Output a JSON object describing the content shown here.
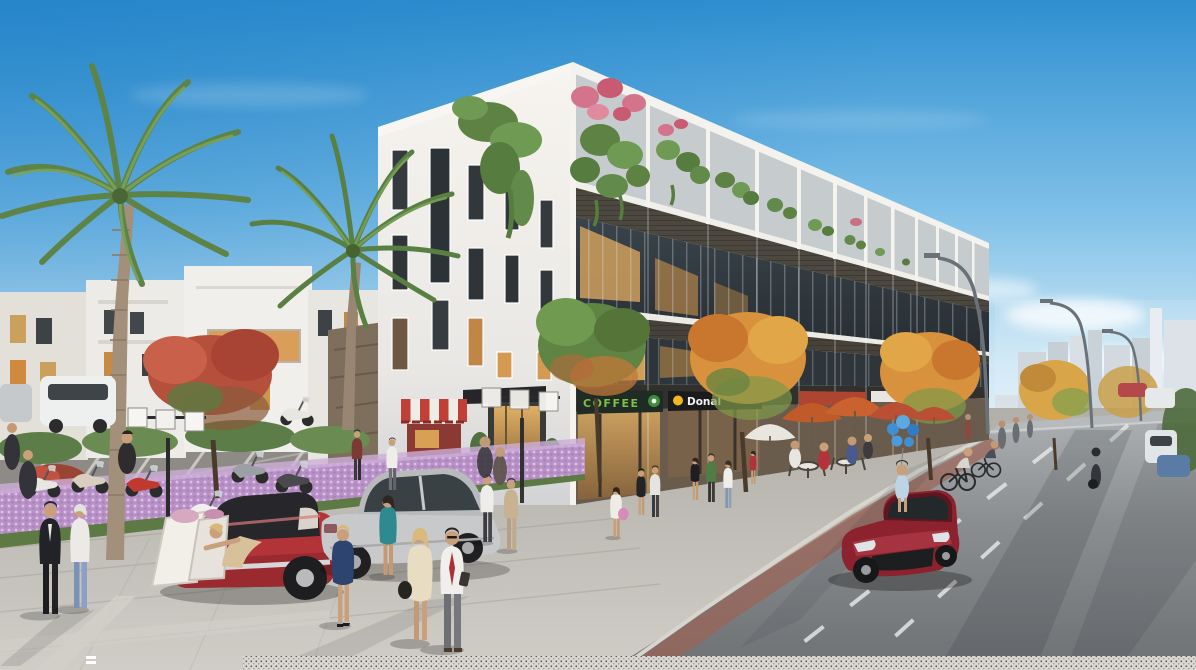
{
  "meta": {
    "description": "Architectural 3D rendering of a modern white shophouse row at a street corner: rooftop terraces with pink bougainvillea and hanging greenery, dark slatted balcony bands, glass storefronts with warm lit interiors, palm trees and flame trees on a plaza with scooter parking and cube street lamps, a lavender flower hedge, pedestrians in summer clothes, a red classic convertible and silver sedan parked on pavers, an outdoor cafe with orange umbrellas and blue balloons, cyclists, and a dark red sports car driving on an asphalt road with dashed lane markings receding toward a distant city skyline under a blue sky."
  },
  "signs": {
    "coffee": {
      "label": "COFFEE",
      "text_color": "#7cc142",
      "bg": "#1f2b24"
    },
    "donal": {
      "label": "Donal",
      "text_color": "#f2f2f0",
      "accent": "#f0b81f",
      "bg": "#1b1b1d"
    }
  },
  "palette": {
    "sky_top": "#2e8fd0",
    "sky_horizon": "#eaf4fa",
    "building_white": "#f4f1ec",
    "slat_band": "#4c473f",
    "glass_dark": "#2e363b",
    "warm_window": "#d59a52",
    "foliage_green": "#5f8747",
    "flower_pink": "#d4748c",
    "flame_tree_orange": "#d8913c",
    "lavender_hedge": "#b791c6",
    "sidewalk": "#c0bdb7",
    "asphalt": "#85888a",
    "bike_lane": "#9b6354",
    "convertible_red": "#b23438",
    "sports_car_red": "#8c222e",
    "sedan_silver": "#c7c9cb",
    "umbrella_orange": "#c05a28",
    "balloon_blue": "#3f8fd4"
  },
  "scene_elements": [
    "sky",
    "clouds",
    "distant-city",
    "left-buildings",
    "main-shophouse-building",
    "rooftop-garden",
    "coffee-sign",
    "donal-sign",
    "striped-vendor-cart",
    "shop-entrance",
    "palm-trees",
    "flame-trees",
    "cube-street-lamps",
    "road-lamps",
    "scooter-parking",
    "lavender-hedge",
    "white-suv",
    "red-convertible",
    "shopping-bags",
    "silver-sedan",
    "red-sports-car",
    "distant-cars",
    "cafe-umbrellas",
    "blue-balloons",
    "cyclists",
    "pedestrians",
    "road-markings",
    "paver-sidewalk",
    "halftone-strip"
  ]
}
